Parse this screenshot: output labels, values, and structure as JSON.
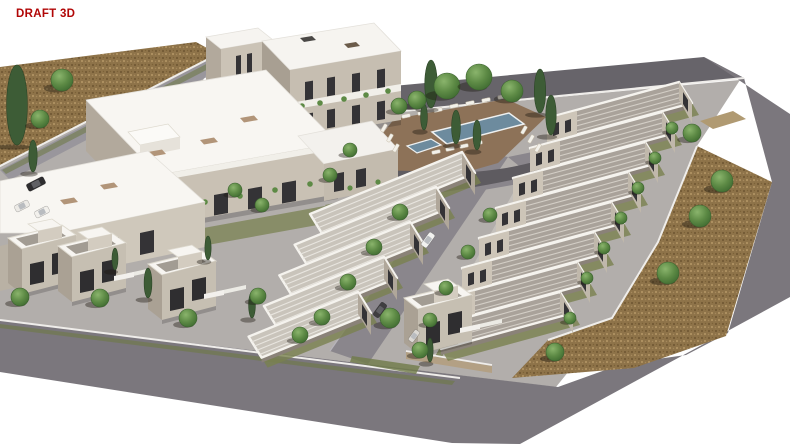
{
  "label": {
    "text": "DRAFT 3D",
    "color": "#b10606"
  },
  "palette": {
    "background": "#ffffff",
    "road_top": "#67646a",
    "road_main": "#7b777d",
    "road_inner": "#8a868c",
    "dirt": "#8e7349",
    "site_ground": "#b2aeab",
    "roof_white": "#f8f6f2",
    "wall_beige": "#c8c0b3",
    "wall_dark": "#a89f92",
    "window_dark": "#343336",
    "tree_green": "#55833f",
    "cypress_green": "#3d5c36",
    "pool_blue": "#6d8b9e",
    "deck_brown": "#8d7258",
    "kerb_white": "#efedea",
    "garden_olive": "#79814f"
  },
  "scene": {
    "trees_round": [
      [
        447,
        86,
        13
      ],
      [
        479,
        77,
        13
      ],
      [
        417,
        100,
        9
      ],
      [
        399,
        106,
        8
      ],
      [
        512,
        91,
        11
      ],
      [
        62,
        80,
        11
      ],
      [
        40,
        119,
        9
      ],
      [
        722,
        181,
        11
      ],
      [
        700,
        216,
        11
      ],
      [
        668,
        273,
        11
      ],
      [
        692,
        133,
        9
      ],
      [
        555,
        352,
        9
      ],
      [
        672,
        128,
        6
      ],
      [
        655,
        158,
        6
      ],
      [
        638,
        188,
        6
      ],
      [
        621,
        218,
        6
      ],
      [
        604,
        248,
        6
      ],
      [
        587,
        278,
        6
      ],
      [
        570,
        318,
        6
      ],
      [
        490,
        215,
        7
      ],
      [
        468,
        252,
        7
      ],
      [
        446,
        288,
        7
      ],
      [
        430,
        320,
        7
      ],
      [
        400,
        212,
        8
      ],
      [
        374,
        247,
        8
      ],
      [
        348,
        282,
        8
      ],
      [
        322,
        317,
        8
      ],
      [
        100,
        298,
        9
      ],
      [
        188,
        318,
        9
      ],
      [
        20,
        297,
        9
      ],
      [
        258,
        296,
        8
      ],
      [
        390,
        318,
        10
      ],
      [
        420,
        350,
        8
      ],
      [
        300,
        335,
        8
      ],
      [
        235,
        190,
        7
      ],
      [
        262,
        205,
        7
      ],
      [
        350,
        150,
        7
      ],
      [
        330,
        175,
        7
      ]
    ],
    "trees_cypress": [
      [
        17,
        145,
        80
      ],
      [
        33,
        172,
        32
      ],
      [
        431,
        108,
        48
      ],
      [
        540,
        113,
        44
      ],
      [
        456,
        144,
        34
      ],
      [
        477,
        150,
        30
      ],
      [
        424,
        130,
        26
      ],
      [
        551,
        135,
        40
      ],
      [
        148,
        298,
        30
      ],
      [
        252,
        318,
        26
      ],
      [
        430,
        362,
        24
      ],
      [
        208,
        260,
        24
      ],
      [
        115,
        270,
        22
      ]
    ],
    "cars": [
      {
        "x": 428,
        "y": 240,
        "r": -54,
        "c": "#f2f2f0",
        "w": 16,
        "h": 7
      },
      {
        "x": 380,
        "y": 310,
        "r": -54,
        "c": "#3f3e40",
        "w": 16,
        "h": 7
      },
      {
        "x": 414,
        "y": 336,
        "r": -54,
        "c": "#dcd9d4",
        "w": 13,
        "h": 6
      },
      {
        "x": 22,
        "y": 206,
        "r": -27,
        "c": "#eceae6",
        "w": 15,
        "h": 7
      },
      {
        "x": 42,
        "y": 212,
        "r": -27,
        "c": "#f2f0ec",
        "w": 15,
        "h": 7
      },
      {
        "x": 36,
        "y": 184,
        "r": -27,
        "c": "#2e2d2f",
        "w": 19,
        "h": 8
      }
    ],
    "loungers": [
      [
        406,
        116,
        -12
      ],
      [
        422,
        113,
        -12
      ],
      [
        438,
        110,
        -12
      ],
      [
        454,
        106,
        -12
      ],
      [
        470,
        103,
        -12
      ],
      [
        486,
        100,
        -12
      ],
      [
        502,
        97,
        -12
      ],
      [
        384,
        128,
        -60
      ],
      [
        390,
        138,
        -60
      ],
      [
        396,
        148,
        -60
      ],
      [
        524,
        130,
        -60
      ],
      [
        531,
        139,
        -60
      ],
      [
        538,
        148,
        -60
      ],
      [
        436,
        152,
        -12
      ],
      [
        450,
        149,
        -12
      ],
      [
        464,
        146,
        -12
      ],
      [
        478,
        143,
        -12
      ]
    ],
    "rows_right": {
      "count": 8,
      "anchor": [
        547,
        118
      ],
      "step": [
        -17,
        30
      ],
      "dir": [
        132,
        -36
      ],
      "width": [
        13,
        21
      ],
      "g": [
        7,
        12
      ],
      "roof": "#a9a29a",
      "rib": "#d3cec6",
      "front": "#cdc5b8",
      "end": "#c0b8ab"
    },
    "rows_left": {
      "count": 5,
      "anchor": [
        462,
        152
      ],
      "step": [
        -26,
        35
      ],
      "dir": [
        -152,
        62
      ],
      "width": [
        13,
        21
      ],
      "g": [
        6,
        10
      ],
      "shrink": 0.07,
      "roof": "#c9c4bb",
      "rib": "#e8e5df",
      "front": "#b0a79a"
    },
    "villas": {
      "anchors": [
        [
          0,
          238
        ],
        [
          50,
          246
        ],
        [
          140,
          264
        ],
        [
          396,
          298
        ]
      ]
    }
  }
}
